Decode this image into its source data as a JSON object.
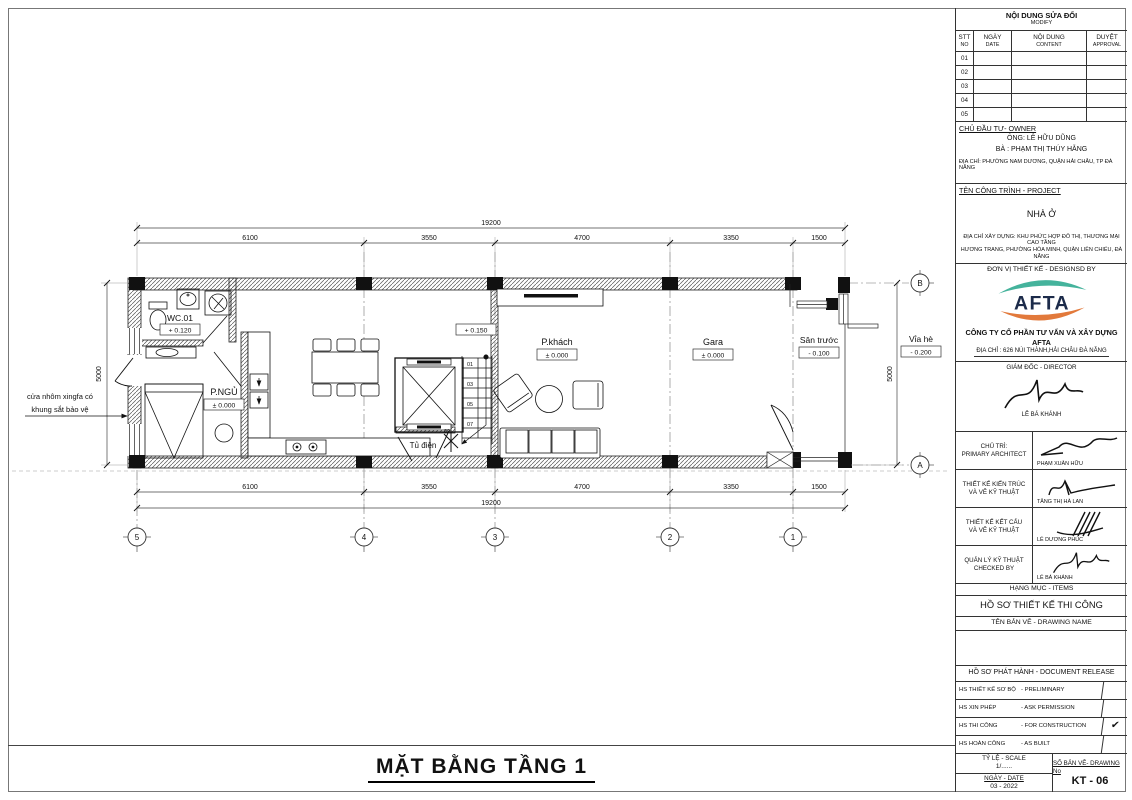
{
  "plan": {
    "title": "MẶT BẰNG TẦNG 1",
    "dim_total": "19200",
    "dim_height": "5000",
    "segments": [
      "6100",
      "3550",
      "4700",
      "3350",
      "1500"
    ],
    "grid_cols": [
      "5",
      "4",
      "3",
      "2",
      "1"
    ],
    "grid_rows": [
      "B",
      "A"
    ],
    "rooms": {
      "wc": {
        "name": "WC.01",
        "level": "+ 0.120"
      },
      "bedroom": {
        "name": "P.NGỦ",
        "level": "± 0.000"
      },
      "living": {
        "name": "P.khách",
        "level": "± 0.000"
      },
      "garage": {
        "name": "Gara",
        "level": "± 0.000"
      },
      "front_yard": {
        "name": "Sân trước",
        "level": "- 0.100"
      },
      "sidewalk": {
        "name": "Vỉa hè",
        "level": "- 0.200"
      },
      "landing_level": "+ 0.150"
    },
    "stair_steps": [
      "01",
      "03",
      "05",
      "07",
      "09"
    ],
    "electrical_cabinet": "Tủ điện",
    "door_note_line1": "cửa nhôm xingfa có",
    "door_note_line2": "khung sắt bảo vệ"
  },
  "titleblock": {
    "revision": {
      "title": "NỘI DUNG SỬA ĐỔI",
      "subtitle": "MODIFY",
      "col1a": "STT",
      "col1b": "NO",
      "col2a": "NGÀY",
      "col2b": "DATE",
      "col3a": "NỘI DUNG",
      "col3b": "CONTENT",
      "col4a": "DUYỆT",
      "col4b": "APPROVAL",
      "rows": [
        "01",
        "02",
        "03",
        "04",
        "05"
      ]
    },
    "owner": {
      "heading": "CHỦ ĐẦU TƯ- OWNER",
      "line1": "ÔNG: LÊ HỮU DŨNG",
      "line2": "BÀ : PHẠM THỊ THÚY HẰNG",
      "address": "ĐỊA CHỈ: PHƯỜNG NAM DƯƠNG, QUẬN HẢI CHÂU, TP ĐÀ NẴNG"
    },
    "project": {
      "heading": "TÊN CÔNG TRÌNH - PROJECT",
      "name": "NHÀ Ở",
      "address1": "ĐỊA CHỈ XÂY DỰNG: KHU PHỨC HỢP ĐÔ THỊ, THƯƠNG MẠI CAO TẦNG",
      "address2": "HƯƠNG TRANG, PHƯỜNG HÒA MINH, QUẬN LIÊN CHIỂU, ĐÀ NẴNG"
    },
    "designer": {
      "heading": "ĐƠN VỊ THIẾT KẾ - DESIGNSD BY",
      "logo_text": "AFTA",
      "company": "CÔNG TY CỔ PHẦN TƯ VẤN VÀ XÂY DỰNG AFTA",
      "address": "ĐỊA CHỈ : 626 NÚI THÀNH,HẢI CHÂU ĐÀ NẴNG",
      "logo_teal": "#45B39C",
      "logo_orange": "#E2793B"
    },
    "director": {
      "role": "GIÁM ĐỐC - DIRECTOR",
      "name": "LÊ BÁ KHÁNH"
    },
    "signatures": [
      {
        "role1": "CHỦ TRÌ:",
        "role2": "PRIMARY ARCHITECT",
        "name": "PHẠM XUÂN HỮU"
      },
      {
        "role1": "THIẾT KẾ KIẾN TRÚC",
        "role2": "VÀ VẼ KỸ THUẬT",
        "name": "TĂNG THỊ HÀ LAN"
      },
      {
        "role1": "THIẾT KẾ KẾT CẤU",
        "role2": "VÀ VẼ KỸ THUẬT",
        "name": "LÊ DƯƠNG PHÚC"
      },
      {
        "role1": "QUẢN LÝ KỸ THUẬT",
        "role2": "CHECKED BY",
        "name": "LÊ BÁ KHÁNH"
      }
    ],
    "items": {
      "heading": "HẠNG MỤC - ITEMS",
      "value": "HỒ SƠ THIẾT KẾ THI CÔNG"
    },
    "drawing_name": {
      "heading": "TÊN BẢN VẼ - DRAWING NAME",
      "value": ""
    },
    "release": {
      "heading": "HỒ SƠ PHÁT HÀNH - DOCUMENT RELEASE",
      "rows": [
        {
          "vn": "HS THIẾT KẾ SƠ BỘ",
          "en": "- PRELIMINARY",
          "check": ""
        },
        {
          "vn": "HS XIN PHÉP",
          "en": "- ASK PERMISSION",
          "check": ""
        },
        {
          "vn": "HS THI CÔNG",
          "en": "- FOR CONSTRUCTION",
          "check": "✔"
        },
        {
          "vn": "HS HOÀN CÔNG",
          "en": "- AS BUILT",
          "check": ""
        }
      ]
    },
    "footer": {
      "scale_label": "TỶ LỆ - SCALE",
      "scale_value": "1/......",
      "date_label": "NGÀY - DATE",
      "date_value": "03 - 2022",
      "no_label": "SỐ BẢN VẼ- DRAWING No",
      "no_value": "KT - 06"
    }
  }
}
